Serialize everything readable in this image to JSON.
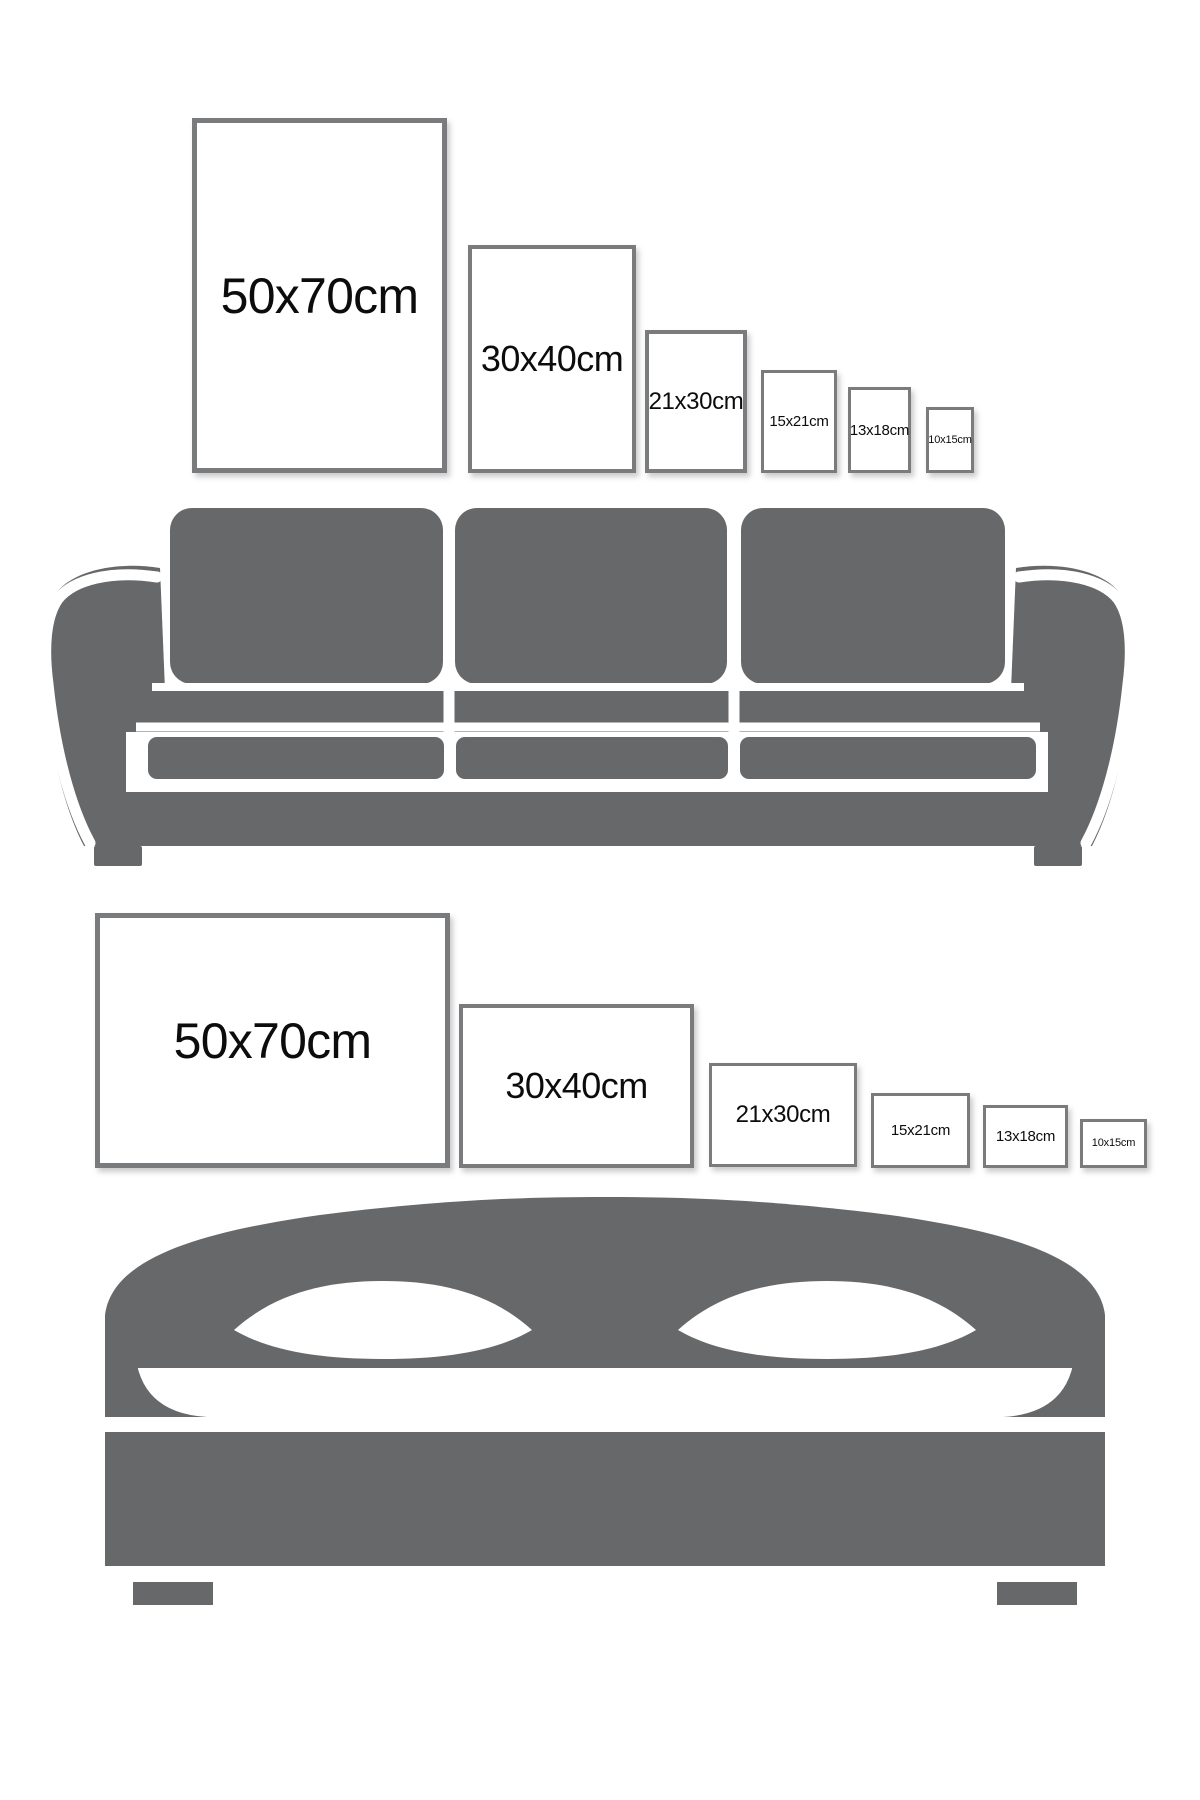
{
  "title": "Poster frame size guide",
  "colors": {
    "background": "#ffffff",
    "furniture_gray": "#67686a",
    "frame_border": "#797b7c",
    "frame_fill": "#ffffff",
    "label_text": "#0c0c0c"
  },
  "sofa_section": {
    "furniture": "sofa",
    "frames": [
      {
        "label": "50x70cm",
        "orientation": "portrait",
        "x": 192,
        "y": 118,
        "w": 255,
        "h": 355,
        "border": 5,
        "font": 50
      },
      {
        "label": "30x40cm",
        "orientation": "portrait",
        "x": 468,
        "y": 245,
        "w": 168,
        "h": 228,
        "border": 4,
        "font": 36
      },
      {
        "label": "21x30cm",
        "orientation": "portrait",
        "x": 645,
        "y": 330,
        "w": 102,
        "h": 143,
        "border": 4,
        "font": 24
      },
      {
        "label": "15x21cm",
        "orientation": "portrait",
        "x": 761,
        "y": 370,
        "w": 76,
        "h": 103,
        "border": 3,
        "font": 15
      },
      {
        "label": "13x18cm",
        "orientation": "portrait",
        "x": 848,
        "y": 387,
        "w": 63,
        "h": 86,
        "border": 3,
        "font": 15
      },
      {
        "label": "10x15cm",
        "orientation": "portrait",
        "x": 926,
        "y": 407,
        "w": 48,
        "h": 66,
        "border": 3,
        "font": 11
      }
    ]
  },
  "bed_section": {
    "furniture": "bed",
    "frames": [
      {
        "label": "50x70cm",
        "orientation": "landscape",
        "x": 95,
        "y": 913,
        "w": 355,
        "h": 255,
        "border": 5,
        "font": 50
      },
      {
        "label": "30x40cm",
        "orientation": "landscape",
        "x": 459,
        "y": 1004,
        "w": 235,
        "h": 164,
        "border": 4,
        "font": 36
      },
      {
        "label": "21x30cm",
        "orientation": "landscape",
        "x": 709,
        "y": 1063,
        "w": 148,
        "h": 104,
        "border": 3,
        "font": 24
      },
      {
        "label": "15x21cm",
        "orientation": "landscape",
        "x": 871,
        "y": 1093,
        "w": 99,
        "h": 75,
        "border": 3,
        "font": 15
      },
      {
        "label": "13x18cm",
        "orientation": "landscape",
        "x": 983,
        "y": 1105,
        "w": 85,
        "h": 63,
        "border": 3,
        "font": 15
      },
      {
        "label": "10x15cm",
        "orientation": "landscape",
        "x": 1080,
        "y": 1119,
        "w": 67,
        "h": 49,
        "border": 3,
        "font": 11
      }
    ]
  }
}
